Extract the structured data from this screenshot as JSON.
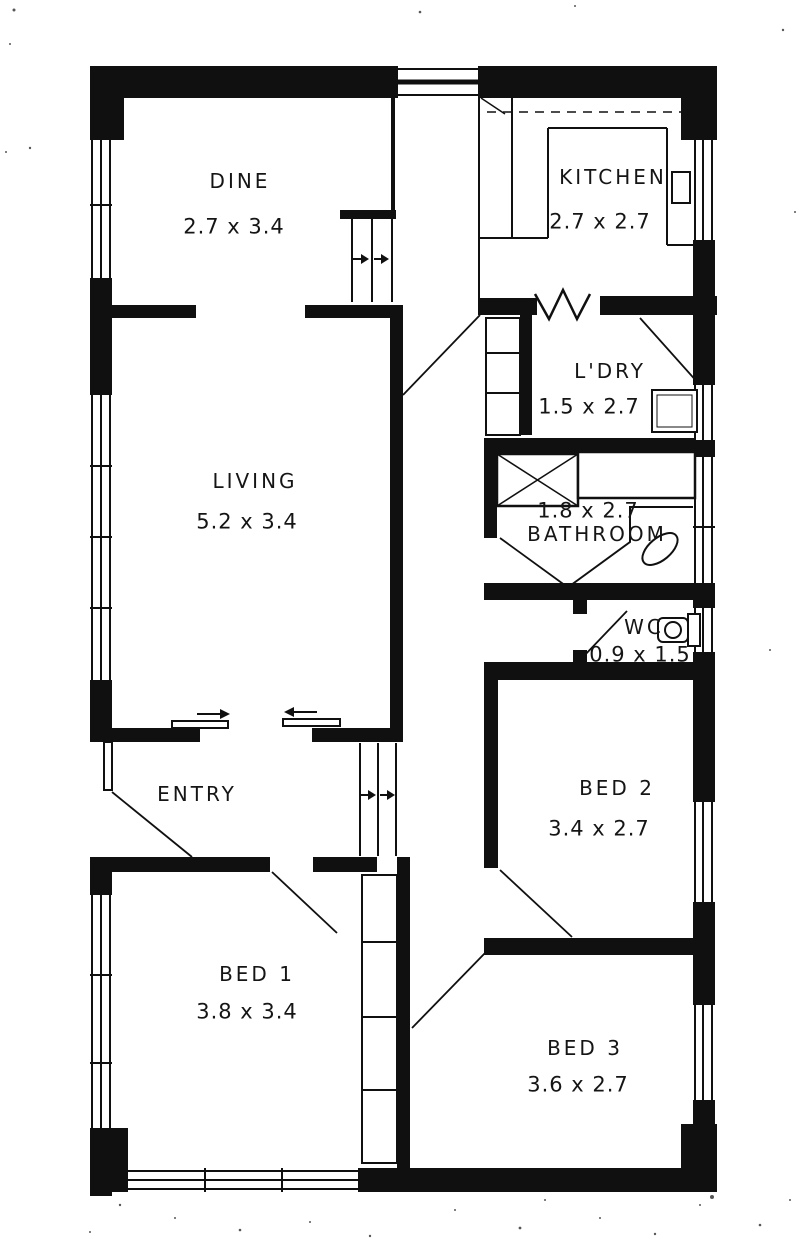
{
  "document": {
    "type": "scanned-floor-plan",
    "colors": {
      "ink": "#101010",
      "paper": "#ffffff"
    }
  },
  "rooms": {
    "dine": {
      "label": "DINE",
      "dims": "2.7 x 3.4"
    },
    "kitchen": {
      "label": "KITCHEN",
      "dims": "2.7 x 2.7"
    },
    "laundry": {
      "label": "L'DRY",
      "dims": "1.5 x 2.7"
    },
    "bathroom": {
      "label": "BATHROOM",
      "dims": "1.8 x 2.7"
    },
    "wc": {
      "label": "WC",
      "dims": "0.9 x 1.5"
    },
    "living": {
      "label": "LIVING",
      "dims": "5.2 x 3.4"
    },
    "entry": {
      "label": "ENTRY"
    },
    "bed1": {
      "label": "BED 1",
      "dims": "3.8 x 3.4"
    },
    "bed2": {
      "label": "BED 2",
      "dims": "3.4 x 2.7"
    },
    "bed3": {
      "label": "BED 3",
      "dims": "3.6 x 2.7"
    }
  }
}
